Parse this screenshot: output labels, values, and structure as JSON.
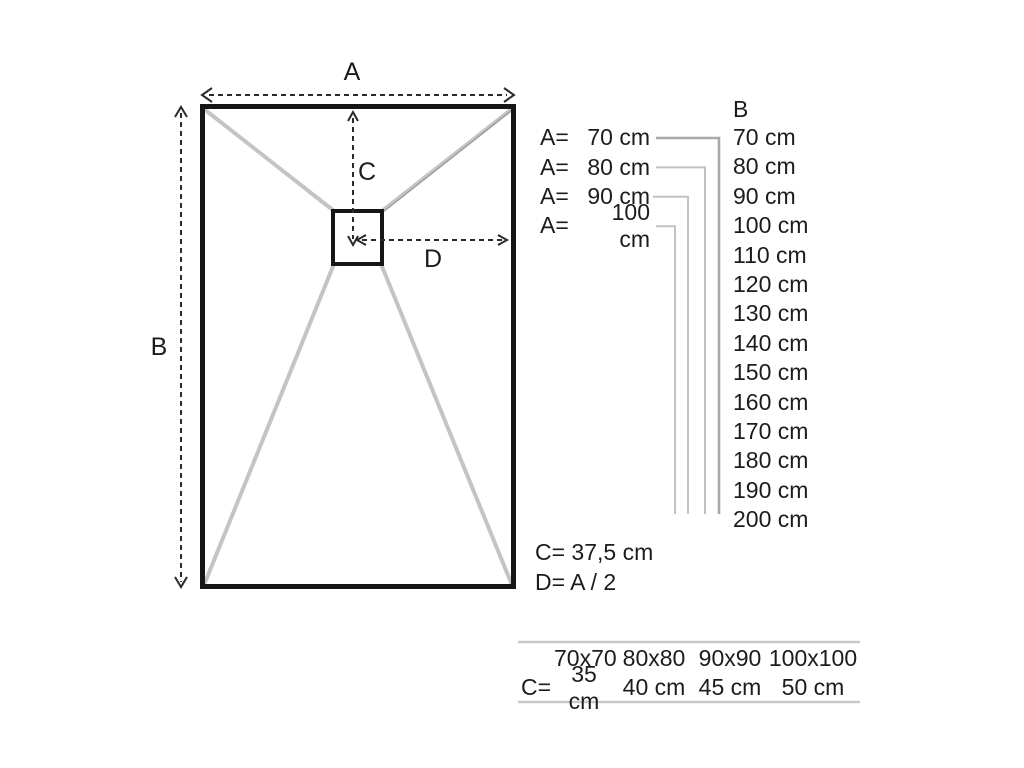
{
  "diagram": {
    "label_a": "A",
    "label_b": "B",
    "label_c": "C",
    "label_d": "D"
  },
  "panel": {
    "a_rows": [
      {
        "label": "A=",
        "value": "70 cm"
      },
      {
        "label": "A=",
        "value": "80 cm"
      },
      {
        "label": "A=",
        "value": "90 cm"
      },
      {
        "label": "A=",
        "value": "100 cm"
      }
    ],
    "b_header": "B",
    "b_values": [
      "70 cm",
      "80 cm",
      "90 cm",
      "100 cm",
      "110 cm",
      "120 cm",
      "130 cm",
      "140 cm",
      "150 cm",
      "160 cm",
      "170 cm",
      "180 cm",
      "190 cm",
      "200 cm"
    ],
    "c_formula": "C= 37,5 cm",
    "d_formula": "D= A / 2"
  },
  "size_table": {
    "sizes": [
      "70x70",
      "80x80",
      "90x90",
      "100x100"
    ],
    "c_label": "C=",
    "c_values": [
      "35 cm",
      "40 cm",
      "45 cm",
      "50 cm"
    ]
  },
  "colors": {
    "outline": "#161616",
    "slope_gray": "#c4c4c4",
    "leader_gray": "#bfbfbf",
    "rule_gray": "#c9c9c9",
    "text": "#1c1c1c"
  }
}
